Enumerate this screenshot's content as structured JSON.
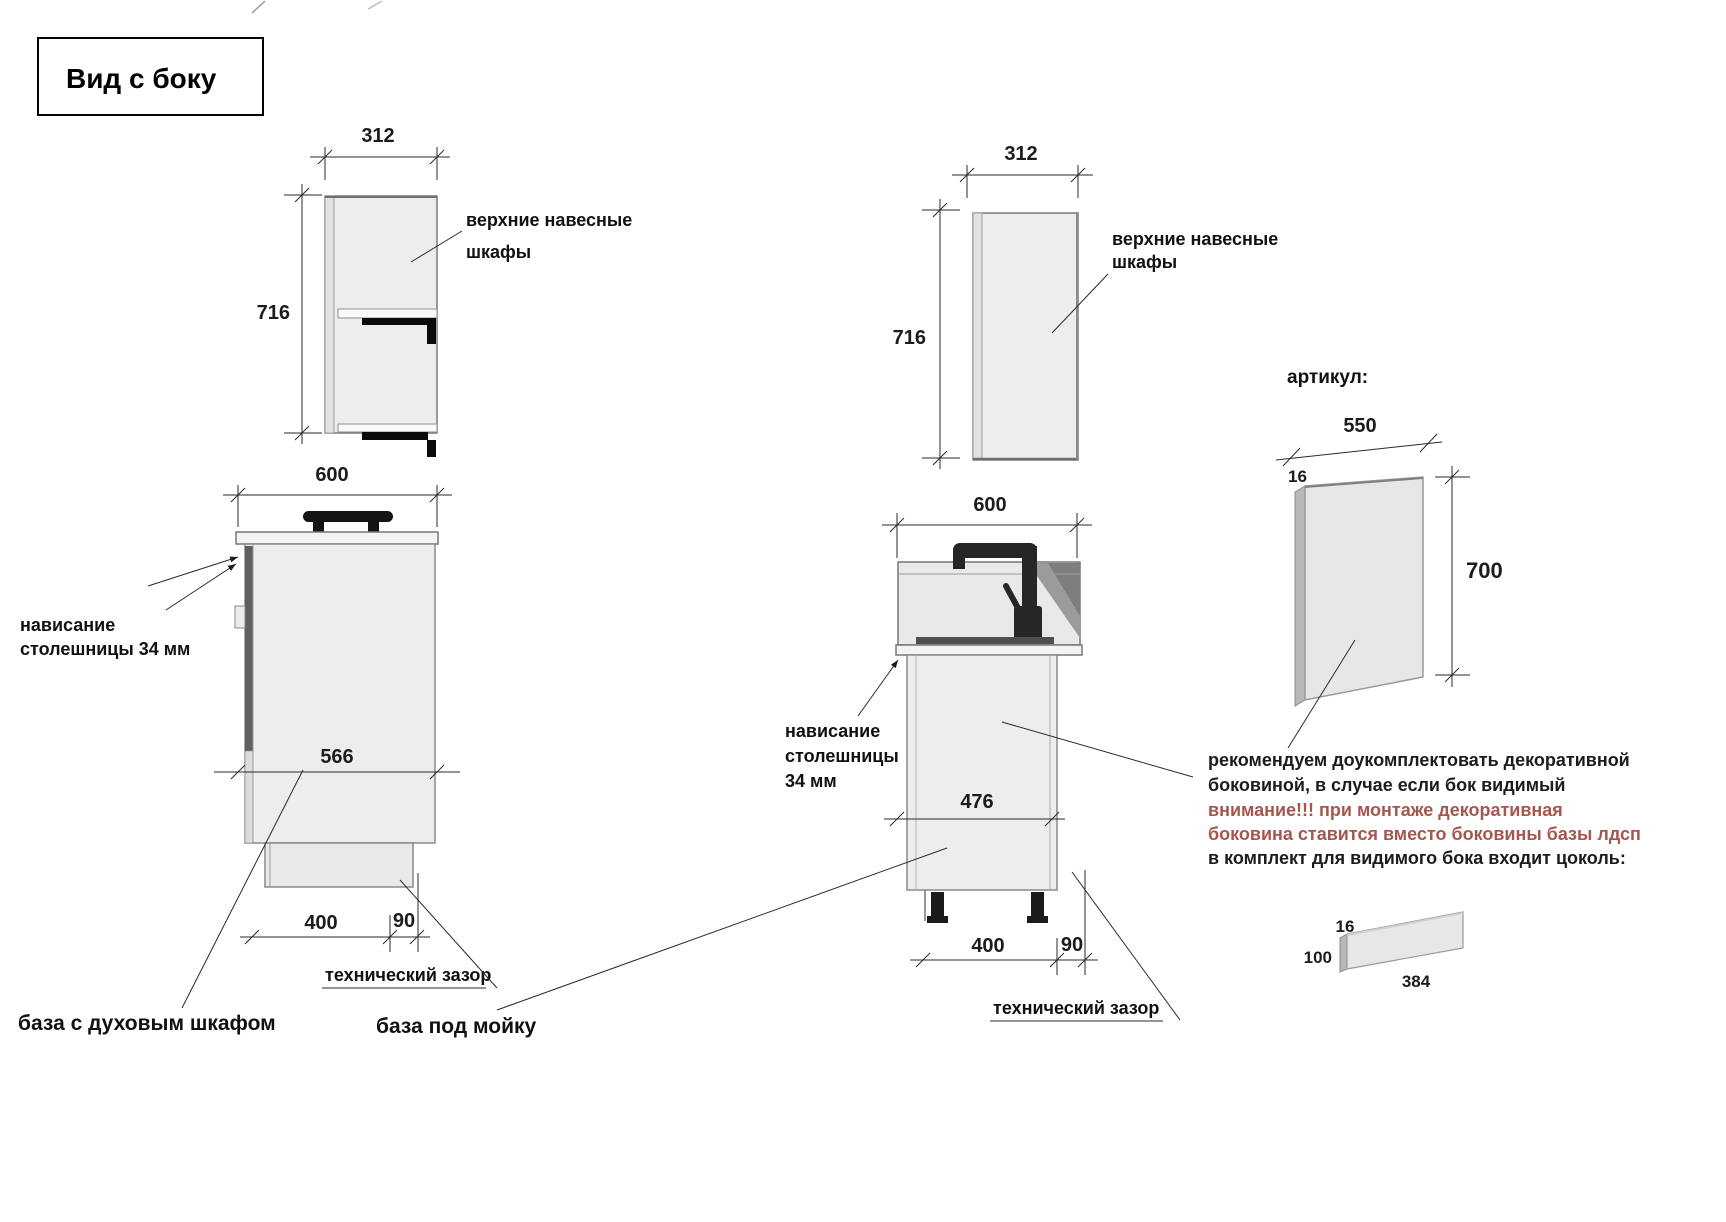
{
  "title": "Вид с боку",
  "colors": {
    "ink": "#1c1c1c",
    "red_text": "#a7564e",
    "cabinet_fill": "#ededed",
    "black_parts": "#111111"
  },
  "wall_cabinet_left": {
    "width": "312",
    "height": "716",
    "label_line1": "верхние навесные",
    "label_line2": "шкафы"
  },
  "wall_cabinet_right": {
    "width": "312",
    "height": "716",
    "label_line1": "верхние навесные",
    "label_line2": "шкафы"
  },
  "oven_base": {
    "name": "база с духовым шкафом",
    "width": "600",
    "depth": "566",
    "leg_dim": "400",
    "gap_dim": "90",
    "overhang_line1": "нависание",
    "overhang_line2": "столешницы 34 мм",
    "gap_label": "технический зазор"
  },
  "sink_base": {
    "name": "база под мойку",
    "width": "600",
    "depth": "476",
    "leg_dim": "400",
    "gap_dim": "90",
    "overhang_line1": "нависание",
    "overhang_line2": "столешницы",
    "overhang_line3": "34 мм",
    "gap_label": "технический зазор"
  },
  "decor_panel": {
    "heading": "артикул:",
    "width": "550",
    "thickness": "16",
    "height": "700"
  },
  "plinth": {
    "thickness": "16",
    "height": "100",
    "length": "384"
  },
  "notes": {
    "lines": [
      {
        "text": "рекомендуем доукомплектовать декоративной",
        "color": "black"
      },
      {
        "text": "боковиной, в случае если бок видимый",
        "color": "black"
      },
      {
        "text": "внимание!!! при монтаже декоративная",
        "color": "red"
      },
      {
        "text": "боковина ставится вместо боковины базы лдсп",
        "color": "red"
      },
      {
        "text": "в комплект для видимого бока входит цоколь:",
        "color": "black"
      }
    ]
  }
}
